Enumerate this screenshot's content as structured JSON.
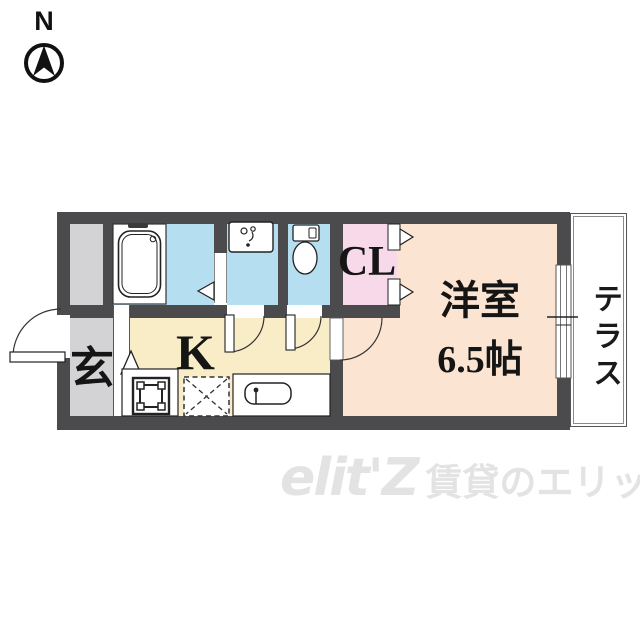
{
  "page": {
    "type": "apartment-floorplan"
  },
  "compass": {
    "label": "N"
  },
  "rooms": {
    "entrance": {
      "label": "玄"
    },
    "kitchen": {
      "label": "K"
    },
    "closet": {
      "label": "CL"
    },
    "western_room": {
      "name": "洋室",
      "size": "6.5帖"
    },
    "terrace": {
      "label": "テラス"
    }
  },
  "fixtures": [
    "bathtub",
    "washbasin",
    "toilet",
    "washing-machine-pan",
    "refrigerator",
    "kitchen-sink"
  ],
  "watermark": {
    "logo": "elit'Z",
    "text": "賃貸のエリッツ"
  },
  "colors": {
    "wall": "#4b4b4d",
    "wet_area": "#b5def1",
    "closet": "#f7d9e9",
    "western_room": "#fbe5d2",
    "kitchen": "#f9edc8",
    "entrance": "#d3d3d5",
    "terrace": "#ffffff",
    "watermark": "#e3e3e3"
  }
}
